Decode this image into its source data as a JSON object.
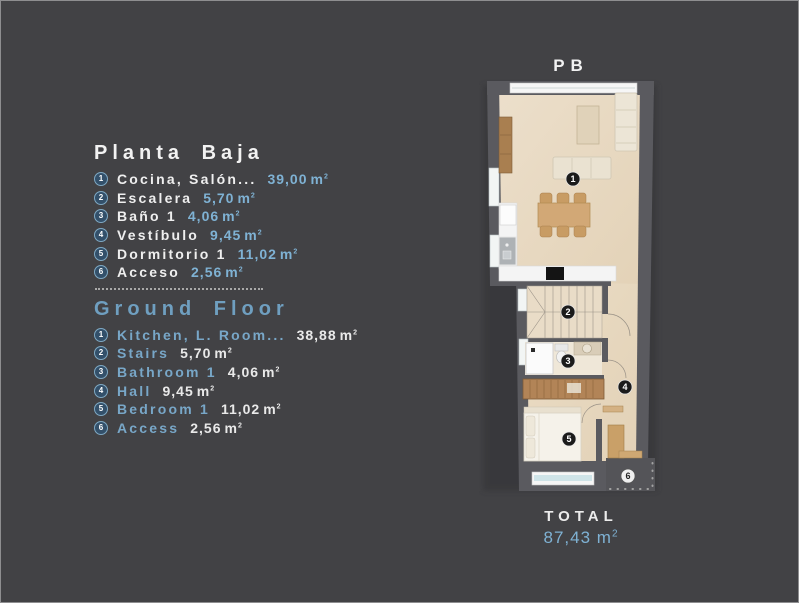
{
  "plan": {
    "floor_label": "PB",
    "total_label": "TOTAL",
    "total_value": "87,43",
    "markers": {
      "m1": "1",
      "m2": "2",
      "m3": "3",
      "m4": "4",
      "m5": "5",
      "m6": "6"
    }
  },
  "unit": {
    "base": "m",
    "sup": "2"
  },
  "lists": {
    "pb": {
      "title": "Planta Baja",
      "items": [
        {
          "n": "1",
          "label": "Cocina, Salón...",
          "value": "39,00"
        },
        {
          "n": "2",
          "label": "Escalera",
          "value": "5,70"
        },
        {
          "n": "3",
          "label": "Baño 1",
          "value": "4,06"
        },
        {
          "n": "4",
          "label": "Vestíbulo",
          "value": "9,45"
        },
        {
          "n": "5",
          "label": "Dormitorio 1",
          "value": "11,02"
        },
        {
          "n": "6",
          "label": "Acceso",
          "value": "2,56"
        }
      ]
    },
    "gf": {
      "title": "Ground Floor",
      "items": [
        {
          "n": "1",
          "label": "Kitchen, L. Room...",
          "value": "38,88"
        },
        {
          "n": "2",
          "label": "Stairs",
          "value": "5,70"
        },
        {
          "n": "3",
          "label": "Bathroom 1",
          "value": "4,06"
        },
        {
          "n": "4",
          "label": "Hall",
          "value": "9,45"
        },
        {
          "n": "5",
          "label": "Bedroom 1",
          "value": "11,02"
        },
        {
          "n": "6",
          "label": "Access",
          "value": "2,56"
        }
      ]
    }
  },
  "colors": {
    "background": "#424245",
    "text_white": "#f2f2f2",
    "accent_blue": "#7fb2d4",
    "heading_blue": "#6f9fc0",
    "bullet_fill": "#33506a",
    "bullet_ring": "#7fa9c4",
    "wall": "#5a5a5f",
    "floor": "#e8dac4",
    "marker_dark": "#1b1b1b",
    "marker_light": "#f0f0f0"
  }
}
